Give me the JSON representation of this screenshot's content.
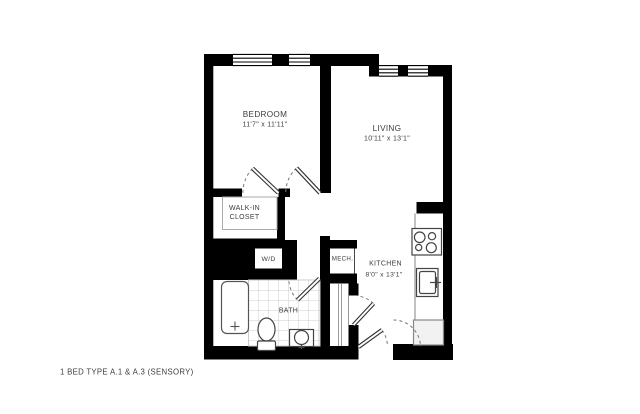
{
  "plan": {
    "footer_label": "1 BED TYPE A.1 & A.3 (SENSORY)",
    "rooms": {
      "bedroom": {
        "name": "BEDROOM",
        "dims": "11'7\" x 11'11\""
      },
      "living": {
        "name": "LIVING",
        "dims": "10'11\" x 13'1\""
      },
      "kitchen": {
        "name": "KITCHEN",
        "dims": "8'0\" x 13'1\""
      },
      "closet": {
        "line1": "WALK-IN",
        "line2": "CLOSET"
      },
      "bath": {
        "name": "BATH"
      },
      "mech": {
        "name": "MECH."
      },
      "laundry": {
        "name": "W/D"
      }
    },
    "colors": {
      "wall": "#000000",
      "background": "#ffffff",
      "tile_line": "#cccccc",
      "fixture_line": "#444444",
      "text": "#3d3d3d"
    }
  }
}
